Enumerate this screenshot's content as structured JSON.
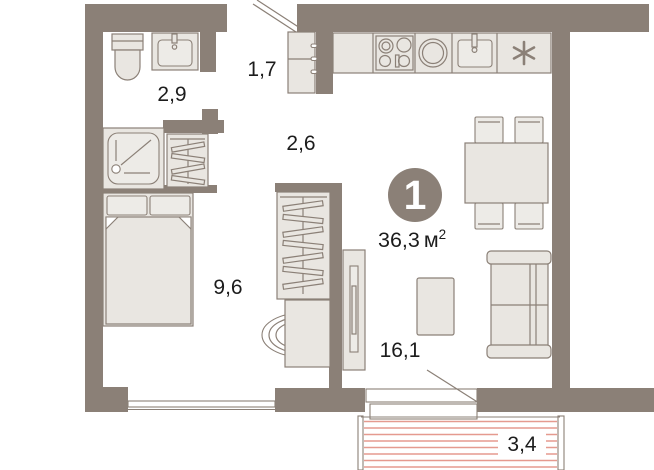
{
  "plan": {
    "unit_badge": {
      "number": "1",
      "area_value": "36,3",
      "area_unit": "м",
      "area_sup": "2"
    },
    "rooms": [
      {
        "name": "bathroom",
        "area": "2,9"
      },
      {
        "name": "hallway",
        "area": "1,7"
      },
      {
        "name": "corridor",
        "area": "2,6"
      },
      {
        "name": "bedroom",
        "area": "9,6"
      },
      {
        "name": "living-room",
        "area": "16,1"
      },
      {
        "name": "balcony",
        "area": "3,4"
      }
    ],
    "icons": {
      "fridge_marker": "✳"
    },
    "colors": {
      "wall": "#8b8077",
      "furniture_fill": "#e9e6e1",
      "furniture_fill_light": "#edebe7",
      "furniture_stroke": "#8b8077",
      "balcony_hatch": "#e59a8f",
      "text": "#1c1c1c",
      "badge_fill": "#8b8077",
      "badge_text": "#ffffff",
      "background": "#ffffff"
    }
  }
}
